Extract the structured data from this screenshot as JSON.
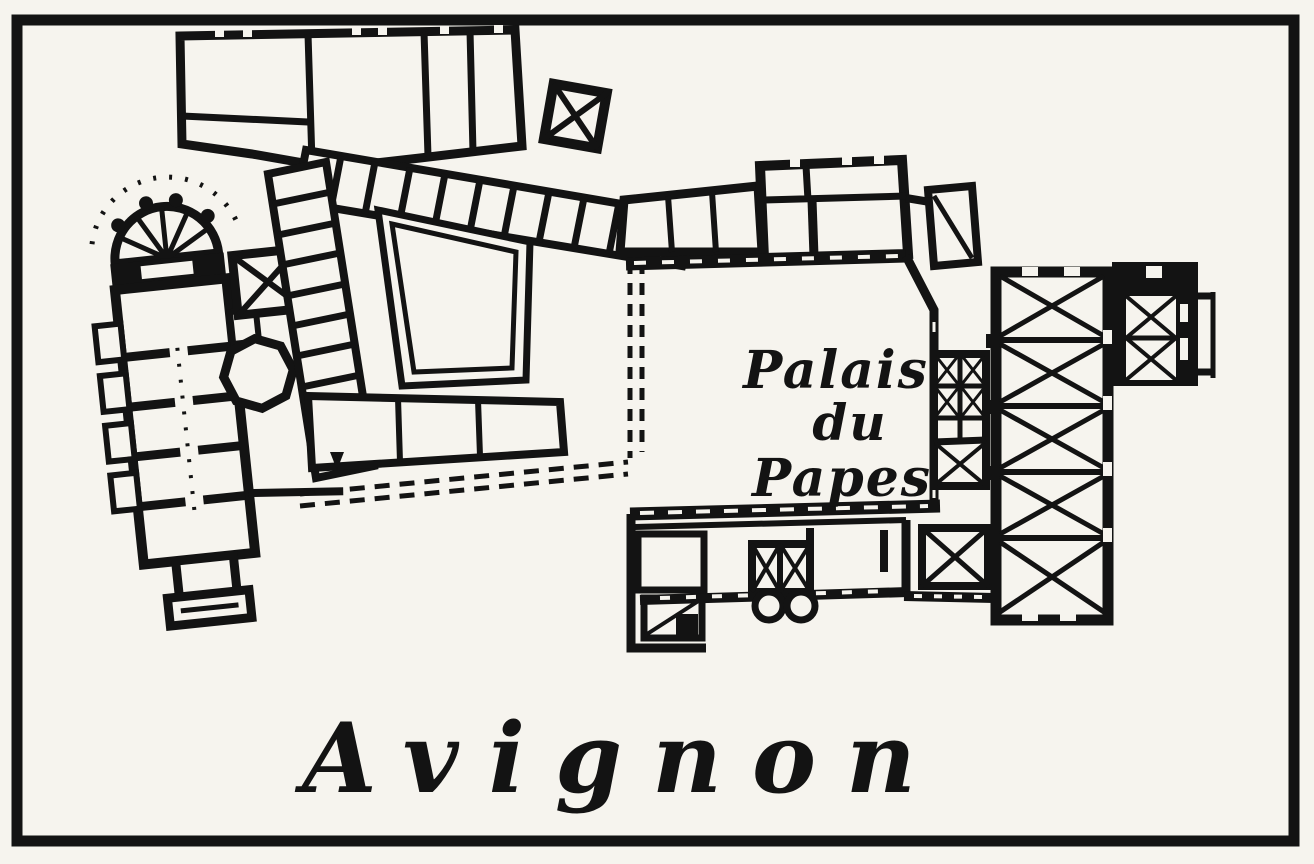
{
  "figure": {
    "kind": "scanned engraved floor plan plate",
    "caption": "Avignon",
    "plan_label": {
      "line1": "Palais",
      "line2": "du",
      "line3": "Papes"
    },
    "colors": {
      "ink": "#131313",
      "paper": "#f6f4ee"
    }
  }
}
